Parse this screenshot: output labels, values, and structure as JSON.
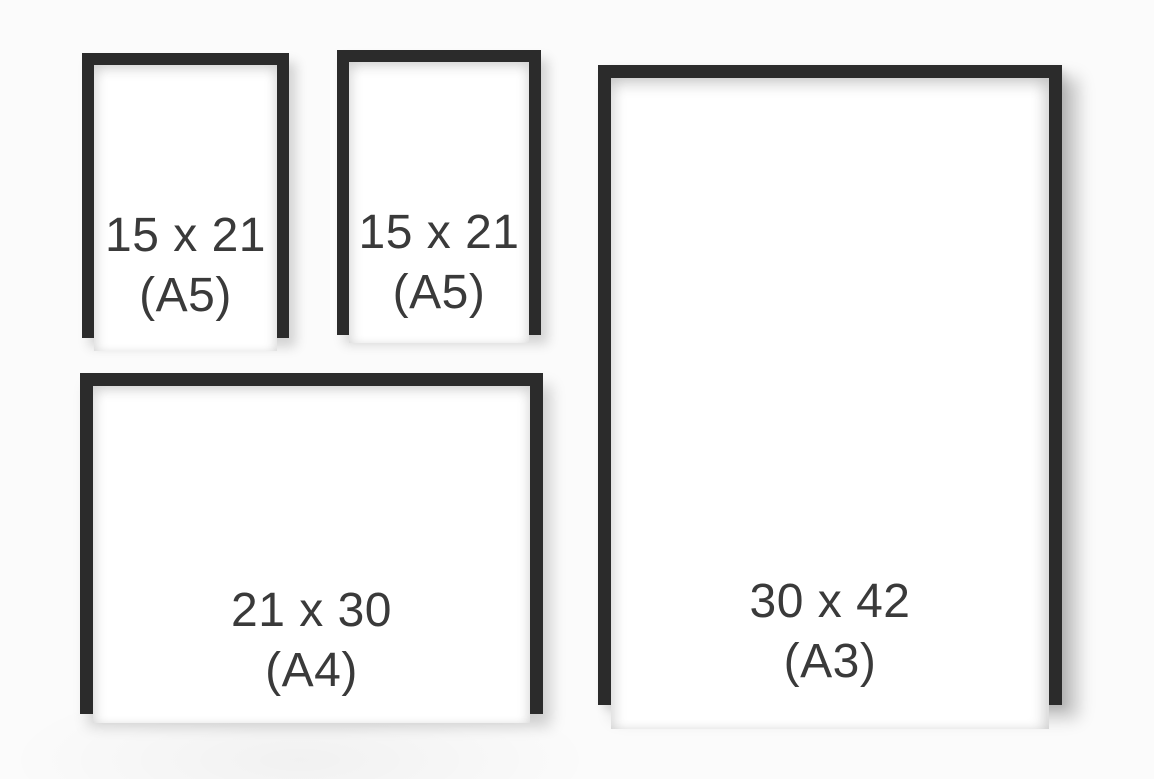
{
  "diagram": {
    "description": "Picture frame size comparison",
    "frames": [
      {
        "id": "a5-left",
        "orientation": "portrait",
        "size_label": "15 x 21",
        "format_label": "(A5)"
      },
      {
        "id": "a5-right",
        "orientation": "portrait",
        "size_label": "15 x 21",
        "format_label": "(A5)"
      },
      {
        "id": "a3",
        "orientation": "portrait",
        "size_label": "30 x 42",
        "format_label": "(A3)"
      },
      {
        "id": "a4",
        "orientation": "landscape",
        "size_label": "21 x 30",
        "format_label": "(A4)"
      }
    ],
    "colors": {
      "frame_border": "#2b2b2b",
      "paper": "#ffffff",
      "label_text": "#3a3a3a",
      "background": "#fbfbfb"
    }
  }
}
